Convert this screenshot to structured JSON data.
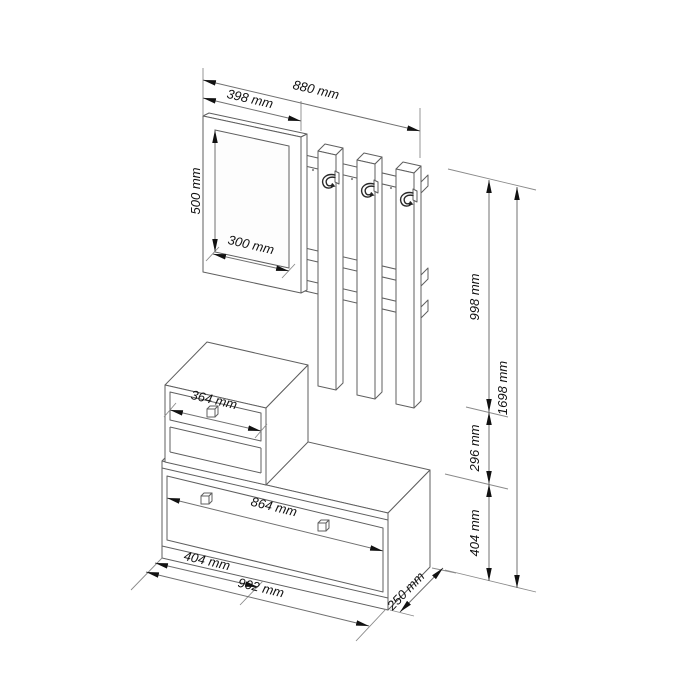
{
  "drawing": {
    "units": "mm",
    "dimensions": {
      "total_width": "880 mm",
      "panel_width": "398 mm",
      "mirror_height": "500 mm",
      "mirror_width": "300 mm",
      "upper_section_height": "998 mm",
      "gap_height": "296 mm",
      "bench_height": "404 mm",
      "total_height": "1698 mm",
      "drawer_width": "364 mm",
      "door_width": "864 mm",
      "cabinet_width": "404 mm",
      "bench_width": "902 mm",
      "bench_depth": "250 mm"
    },
    "colors": {
      "background": "#ffffff",
      "structure_line": "#5f5f5f",
      "dimension_line": "#707070",
      "annotation": "#111111"
    }
  }
}
